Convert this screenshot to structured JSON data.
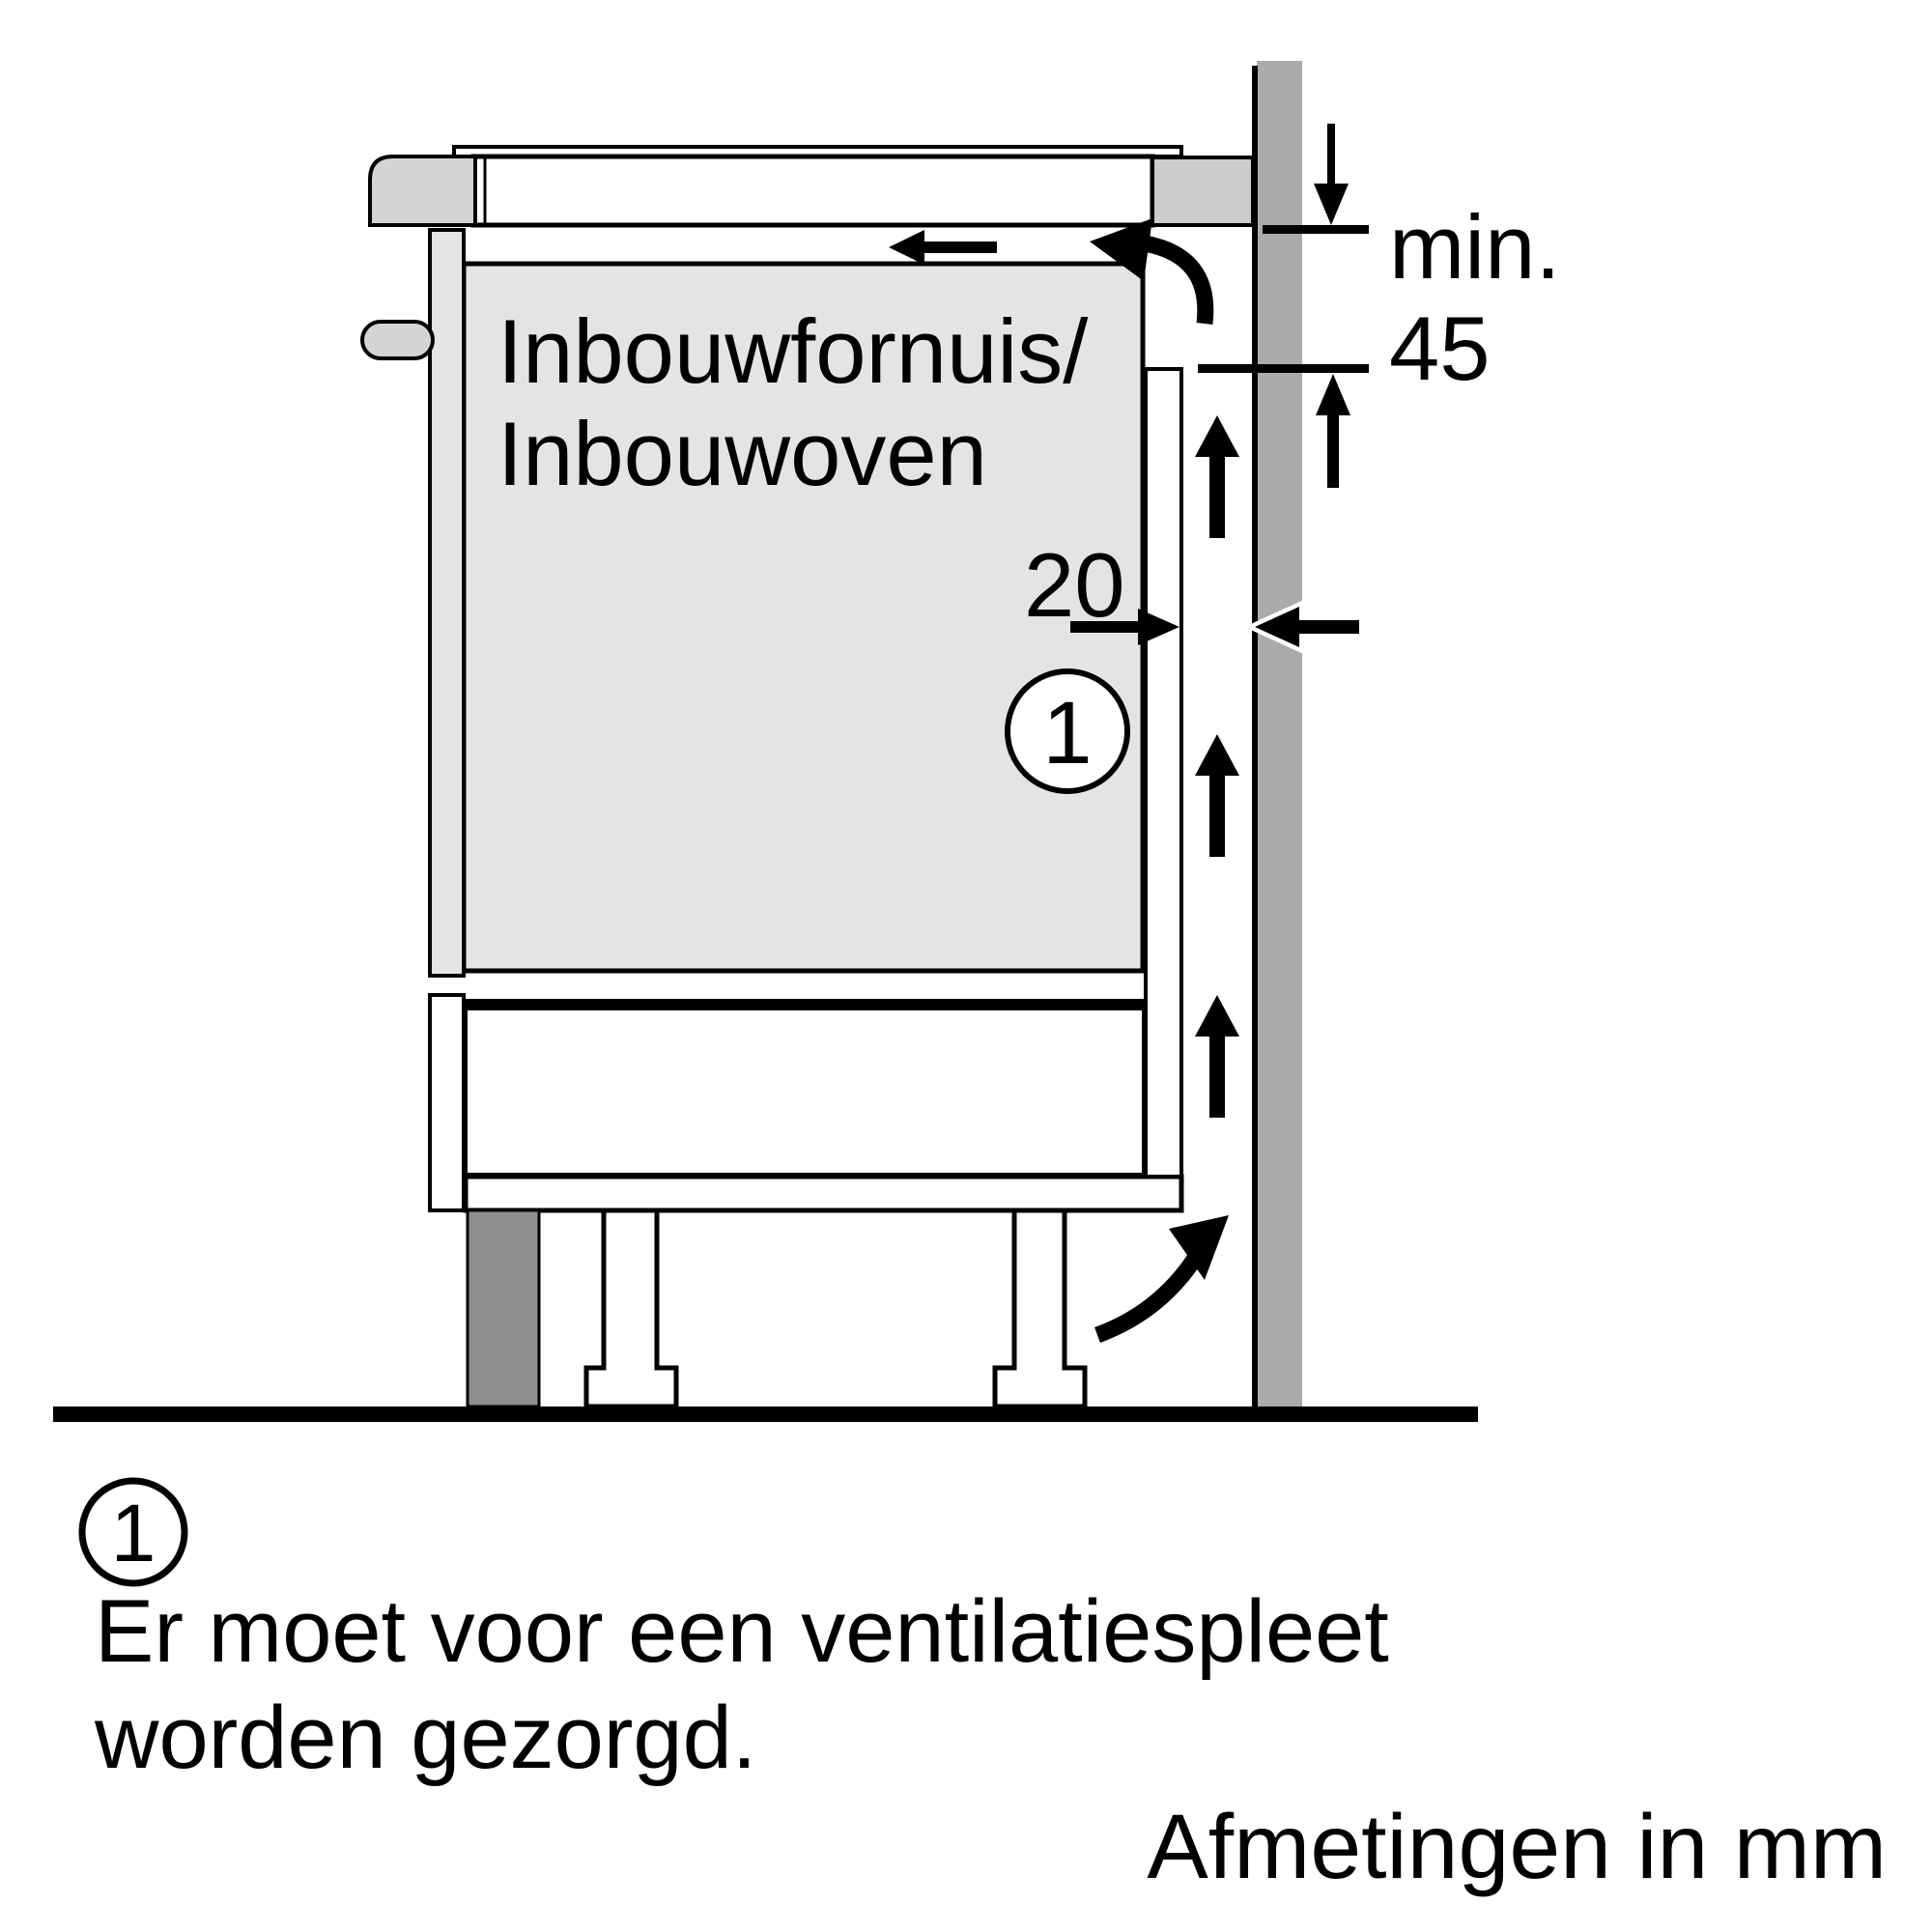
{
  "diagram": {
    "appliance_label": {
      "line1": "Inbouwfornuis/",
      "line2": "Inbouwoven"
    },
    "dimensions": {
      "min_label": "min.",
      "min_value": "45",
      "gap_value": "20"
    },
    "callout": {
      "number": "1"
    },
    "colors": {
      "wall": "#ababab",
      "cabinet_fill": "#e4e4e4",
      "hob_edge": "#d4d4d4",
      "worktop_back_block": "#cccccc",
      "plinth": "#8e8e8e",
      "line": "#000000"
    }
  },
  "footnote": {
    "marker": "1",
    "line1": "Er moet voor een ventilatiespleet",
    "line2": "worden gezorgd."
  },
  "units_note": "Afmetingen in mm"
}
